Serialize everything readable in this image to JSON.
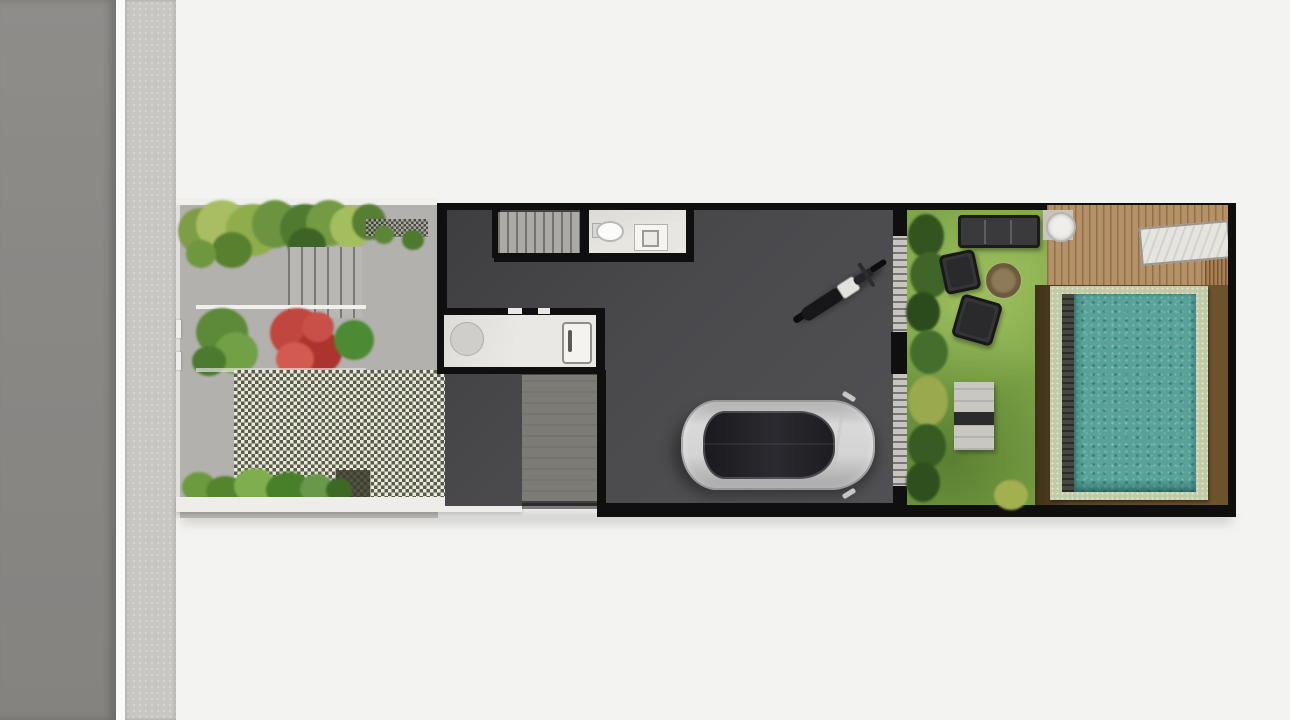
{
  "scene": {
    "kind": "architectural-site-plan-render",
    "view": "top-down",
    "description": "Top-down 3D rendered site plan of a narrow tropical house lot: street and sidewalk on the left, front garden with steps and grass-block pavers, dark-floored garage with car and motorcycle, service rooms (stairs, bathroom, kitchen), and a backyard with lawn, outdoor furniture, fire pit, wooden deck and swimming pool."
  },
  "palette": {
    "page_bg": "#f3f3f1",
    "street": "#8b8885",
    "sidewalk": "#c8c7c4",
    "paving": "#b2b1ad",
    "wall": "#0f0f0f",
    "house_floor": "#4a4a4d",
    "checker_dark": "#575c48",
    "checker_light": "#ebe9de",
    "lawn": "#7da647",
    "deck_wood": "#b59168",
    "pool_water": "#58a29a",
    "pool_coping": "#c2cba8",
    "soil_brown": "#5a4526",
    "red_shrub": "#c0463f",
    "car_body": "#d3d3d3",
    "car_glass": "#1f1f23"
  },
  "areas": {
    "street": {
      "label": "Street"
    },
    "sidewalk": {
      "label": "Sidewalk"
    },
    "front_garden": {
      "label": "Front garden",
      "features": [
        "foliage band",
        "gravel strip",
        "entry steps",
        "flowering planter",
        "grass-block paver court",
        "fern bed",
        "entry gate"
      ]
    },
    "house": {
      "label": "House / garage",
      "features": [
        "staircase",
        "bathroom",
        "kitchen counter",
        "carport slab",
        "parked car",
        "parked motorcycle",
        "glass sliding door"
      ]
    },
    "backyard": {
      "label": "Backyard",
      "features": [
        "hedge",
        "lawn",
        "sofa",
        "two armchairs",
        "fire pit",
        "garden bench",
        "wooden deck",
        "round table",
        "sun lounger",
        "swimming pool"
      ]
    }
  },
  "objects": {
    "car": {
      "label": "Car (top view)",
      "color": "silver"
    },
    "motorcycle": {
      "label": "Motorcycle (top view)",
      "color": "black"
    },
    "pool": {
      "label": "Swimming pool",
      "water": "teal"
    },
    "sofa": {
      "label": "Outdoor sofa",
      "color": "dark gray"
    },
    "fire_pit": {
      "label": "Fire pit"
    },
    "deck_table": {
      "label": "Round deck table"
    },
    "lounger": {
      "label": "Sun lounger"
    }
  }
}
